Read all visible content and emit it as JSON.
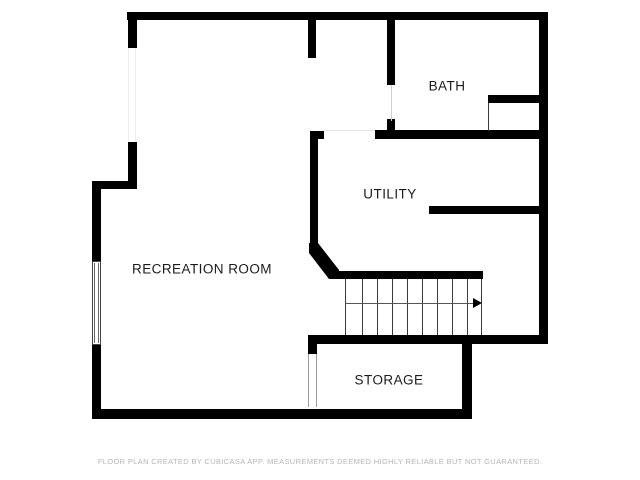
{
  "floor_plan": {
    "title": "Basement floor plan",
    "rooms": [
      {
        "id": "recreation-room",
        "label": "RECREATION ROOM"
      },
      {
        "id": "bath",
        "label": "BATH"
      },
      {
        "id": "utility",
        "label": "UTILITY"
      },
      {
        "id": "storage",
        "label": "STORAGE"
      }
    ],
    "symbols": {
      "staircase": {
        "treads": 9,
        "direction_arrow": "right"
      },
      "window": {
        "wall": "left"
      }
    },
    "footer": "FLOOR PLAN CREATED BY CUBICASA APP. MEASUREMENTS DEEMED HIGHLY RELIABLE BUT NOT GUARANTEED.",
    "colors": {
      "wall": "#000000",
      "background": "#ffffff",
      "label_text": "#1b1b1b",
      "footer_text": "#b5b5b5",
      "stair_lines": "#3a3a3a",
      "opening_lines": "#e0e0e0"
    }
  }
}
